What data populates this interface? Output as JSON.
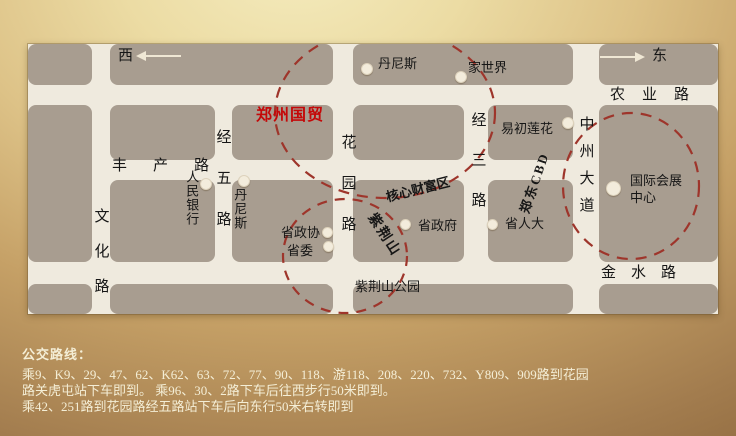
{
  "map": {
    "compass": {
      "west": "西",
      "east": "东"
    },
    "title": "郑州国贸",
    "roads": {
      "nongye": "农业路",
      "fengchan": "丰产路",
      "jinshui": "金水路",
      "wenhua": "文化路",
      "jingwu": "经五路",
      "huayuan": "花园路",
      "jingsan": "经三路",
      "zhongzhou": "中州大道"
    },
    "pois": {
      "dennis_north": "丹尼斯",
      "jiashijie": "家世界",
      "yichulianhua": "易初莲花",
      "renmin_bank": "人民银行",
      "dennis_west": "丹尼斯",
      "shengzhengxie": "省政协",
      "shengwei": "省委",
      "shengzhengfu": "省政府",
      "shengrenda": "省人大",
      "exhibition_line1": "国际会展",
      "exhibition_line2": "中心"
    },
    "areas": {
      "core_wealth": "核心财富区",
      "zijinshan": "紫荆山",
      "zijinshan_park": "紫荆山公园",
      "zhengdong_cbd": "郑东CBD"
    },
    "colors": {
      "highlight_circle": "#9e352b",
      "title_red": "#c40808",
      "city_block": "#a89d90",
      "road": "#efeade"
    }
  },
  "bus_info": {
    "heading": "公交路线：",
    "lines": [
      "乘9、K9、29、47、62、K62、63、72、77、90、118、游118、208、220、732、Y809、909路到花园",
      "路关虎屯站下车即到。 乘96、30、2路下车后往西步行50米即到。",
      "乘42、251路到花园路经五路站下车后向东行50米右转即到"
    ]
  }
}
